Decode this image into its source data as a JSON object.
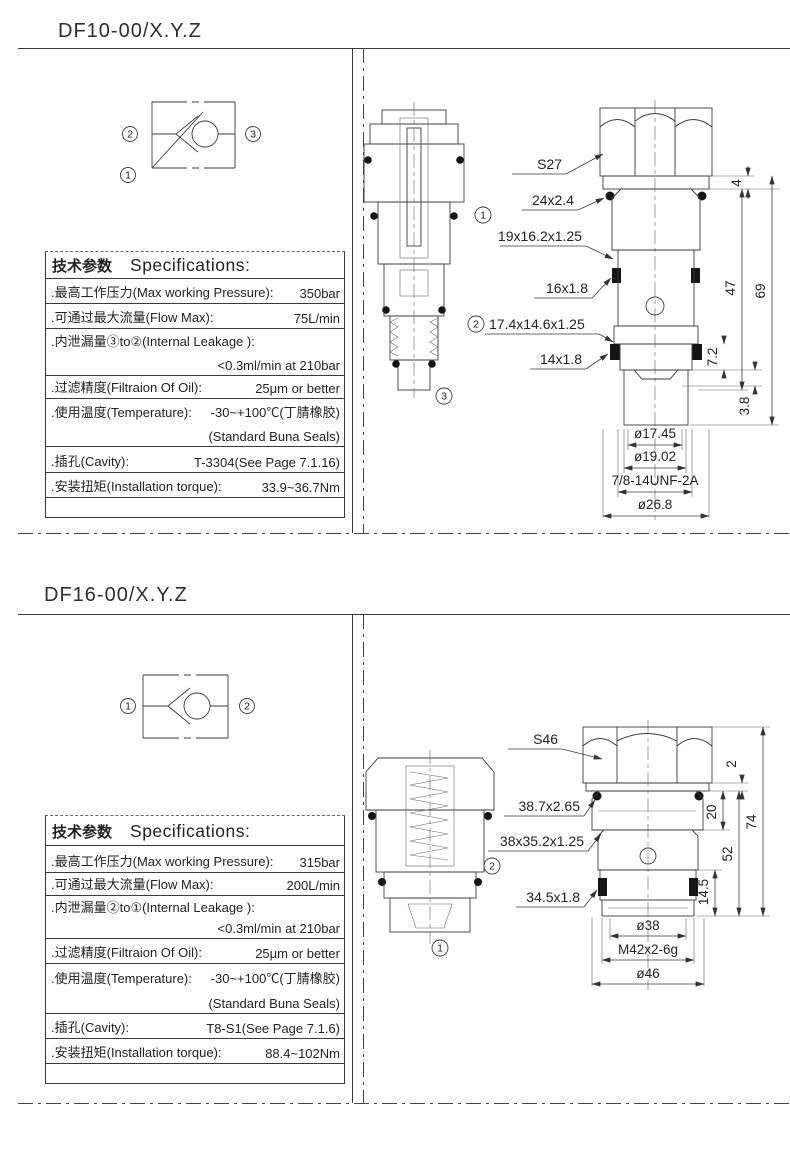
{
  "page": {
    "bg": "#ffffff",
    "line_color": "#3a3a3a"
  },
  "sections": [
    {
      "title": "DF10-00/X.Y.Z",
      "symbol": {
        "port_left": "2",
        "port_right": "3",
        "port_bottom": "1"
      },
      "specs": {
        "header_cn": "技术参数",
        "header_en": "Specifications:",
        "pressure_label": ".最高工作压力(Max working Pressure):",
        "pressure_value": "350bar",
        "flow_label": ".可通过最大流量(Flow Max):",
        "flow_value": "75L/min",
        "leakage_label": ".内泄漏量③to②(Internal Leakage ):",
        "leakage_value": "<0.3ml/min at 210bar",
        "filtration_label": ".过滤精度(Filtraion Of Oil):",
        "filtration_value": "25μm or better",
        "temperature_label": ".使用温度(Temperature):",
        "temperature_value": "-30~+100℃(丁腈橡胶)",
        "temperature_value2": "(Standard Buna Seals)",
        "cavity_label": ".插孔(Cavity):",
        "cavity_value": "T-3304(See Page 7.1.16)",
        "torque_label": ".安装扭矩(Installation torque):",
        "torque_value": "33.9~36.7Nm"
      },
      "drawing": {
        "wrench_label": "S27",
        "seal1": "24x2.4",
        "seal2": "19x16.2x1.25",
        "seal3": "16x1.8",
        "seal4": "17.4x14.6x1.25",
        "seal4_port": "2",
        "seal5": "14x1.8",
        "dia1": "ø17.45",
        "dia2": "ø19.02",
        "thread": "7/8-14UNF-2A",
        "dia3": "ø26.8",
        "dim_washer": "4",
        "dim_overall": "69",
        "dim_mid": "47",
        "dim_groove": "7.2",
        "dim_tip": "3.8",
        "port1": "1",
        "port3": "3"
      }
    },
    {
      "title": "DF16-00/X.Y.Z",
      "symbol": {
        "port_left": "1",
        "port_right": "2"
      },
      "specs": {
        "header_cn": "技术参数",
        "header_en": "Specifications:",
        "pressure_label": ".最高工作压力(Max working Pressure):",
        "pressure_value": "315bar",
        "flow_label": ".可通过最大流量(Flow Max):",
        "flow_value": "200L/min",
        "leakage_label": ".内泄漏量②to①(Internal Leakage ):",
        "leakage_value": "<0.3ml/min at 210bar",
        "filtration_label": ".过滤精度(Filtraion Of Oil):",
        "filtration_value": "25μm or better",
        "temperature_label": ".使用温度(Temperature):",
        "temperature_value": "-30~+100℃(丁腈橡胶)",
        "temperature_value2": "(Standard Buna Seals)",
        "cavity_label": ".插孔(Cavity):",
        "cavity_value": "T8-S1(See Page 7.1.6)",
        "torque_label": ".安装扭矩(Installation torque):",
        "torque_value": "88.4~102Nm"
      },
      "drawing": {
        "wrench_label": "S46",
        "seal1": "38.7x2.65",
        "seal2": "38x35.2x1.25",
        "seal3": "34.5x1.8",
        "dia1": "ø38",
        "thread": "M42x2-6g",
        "dia2": "ø46",
        "dim_washer": "2",
        "dim_overall": "74",
        "dim_mid": "20",
        "dim_lower": "52",
        "dim_tip": "14.5",
        "port1": "1",
        "port2": "2"
      }
    }
  ]
}
